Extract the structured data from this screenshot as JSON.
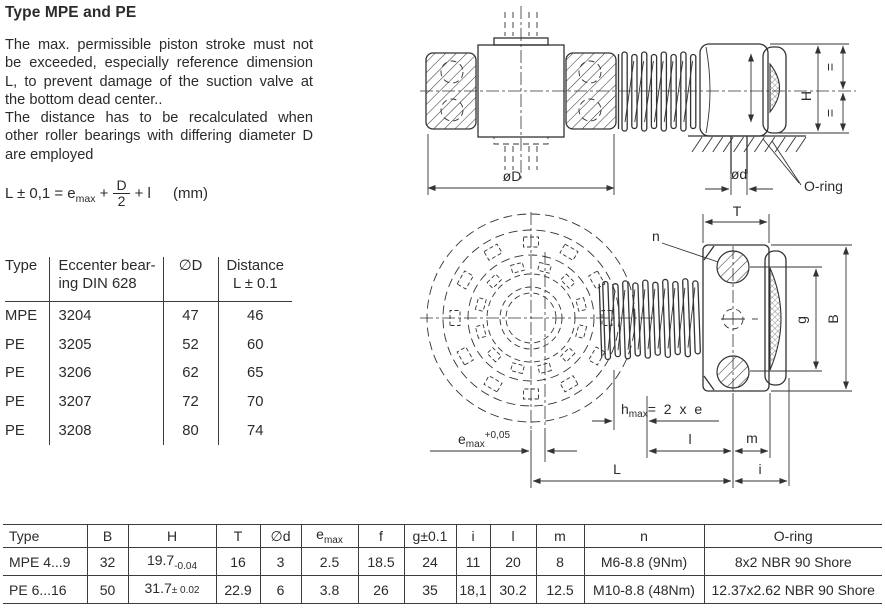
{
  "title": "Type MPE and PE",
  "paragraph": [
    "The max. permissible piston stroke must not",
    "be exceeded, especially reference dimension",
    "L, to prevent damage of the suction valve at",
    "the bottom dead center..",
    "The distance has to be recalculated when",
    "other roller bearings with differing diameter D",
    "are employed"
  ],
  "formula": {
    "lead": "L ± 0,1 = e",
    "sub": "max",
    "op": "+",
    "num": "D",
    "den": "2",
    "tail": "+ l",
    "unit": "(mm)"
  },
  "bearing_table": {
    "headers": {
      "type": "Type",
      "bearing": [
        "Eccenter bear-",
        "ing DIN 628"
      ],
      "diameter": "∅D",
      "distance": [
        "Distance",
        "L ± 0.1"
      ]
    },
    "rows": [
      [
        "MPE",
        "3204",
        "47",
        "46"
      ],
      [
        "PE",
        "3205",
        "52",
        "60"
      ],
      [
        "PE",
        "3206",
        "62",
        "65"
      ],
      [
        "PE",
        "3207",
        "72",
        "70"
      ],
      [
        "PE",
        "3208",
        "80",
        "74"
      ]
    ]
  },
  "dim_table": {
    "headers": {
      "type": "Type",
      "b": "B",
      "h": "H",
      "t": "T",
      "d": "∅d",
      "e_main": "e",
      "e_sub": "max",
      "f": "f",
      "g": "g±0.1",
      "i": "i",
      "l": "l",
      "m": "m",
      "n": "n",
      "oring": "O-ring"
    },
    "rows": [
      {
        "type": "MPE 4...9",
        "b": "32",
        "h": "19.7",
        "h_sub": "-0.04",
        "h_tail": "",
        "t": "16",
        "d": "3",
        "e": "2.5",
        "f": "18.5",
        "g": "24",
        "i": "11",
        "l": "20",
        "m": "8",
        "n": "M6-8.8 (9Nm)",
        "oring": "8x2 NBR 90 Shore"
      },
      {
        "type": "PE 6...16",
        "b": "50",
        "h": "31.7",
        "h_sub": "",
        "h_tail": "± 0.02",
        "t": "22.9",
        "d": "6",
        "e": "3.8",
        "f": "26",
        "g": "35",
        "i": "18,1",
        "l": "30.2",
        "m": "12.5",
        "n": "M10-8.8 (48Nm)",
        "oring": "12.37x2.62 NBR 90 Shore"
      }
    ]
  },
  "drawings": {
    "top": {
      "outer_dia": "øD",
      "small_dia": "ød",
      "height": "H",
      "eq_top": "=",
      "eq_bottom": "=",
      "oring": "O-ring"
    },
    "bottom": {
      "T": "T",
      "n": "n",
      "g": "g",
      "B": "B",
      "hmax": {
        "main": "h",
        "sub": "max",
        "rest": "= 2 x e"
      },
      "emax": {
        "main": "e",
        "sub": "max",
        "sup": "+0,05"
      },
      "l": "l",
      "m": "m",
      "L": "L",
      "i": "i"
    }
  }
}
